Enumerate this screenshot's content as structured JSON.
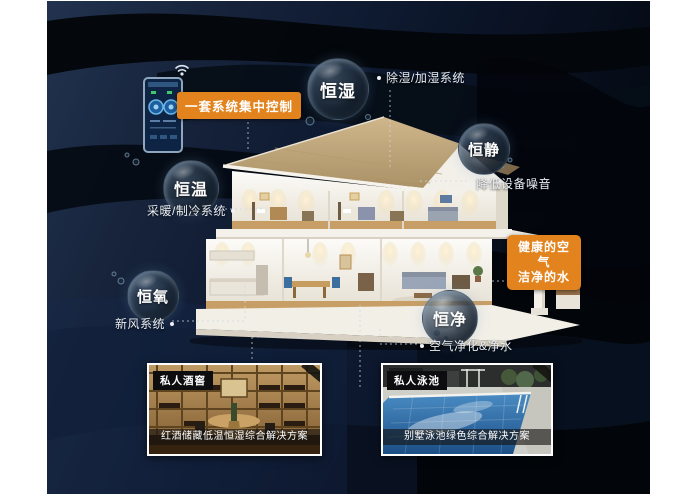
{
  "colors": {
    "accent": "#e2831e",
    "canvas_navy": "#0e1a30",
    "bubble_rim": "#96b6d4"
  },
  "controller": {
    "label": "一套系统集中控制"
  },
  "bubbles": {
    "humidity": {
      "label": "恒湿",
      "note": "除湿/加湿系统"
    },
    "quiet": {
      "label": "恒静",
      "note": "降低设备噪音"
    },
    "temp": {
      "label": "恒温",
      "note": "采暖/制冷系统"
    },
    "oxygen": {
      "label": "恒氧",
      "note": "新风系统"
    },
    "clean": {
      "label": "恒净",
      "note": "空气净化&净水"
    }
  },
  "highlight": {
    "line1": "健康的空气",
    "line2": "洁净的水"
  },
  "cards": {
    "wine": {
      "tag": "私人酒窖",
      "caption": "红酒储藏低温恒湿综合解决方案"
    },
    "pool": {
      "tag": "私人泳池",
      "caption": "别墅泳池绿色综合解决方案"
    }
  },
  "icons": {
    "wifi": "wifi-icon",
    "phone": "smart-home-controller"
  }
}
